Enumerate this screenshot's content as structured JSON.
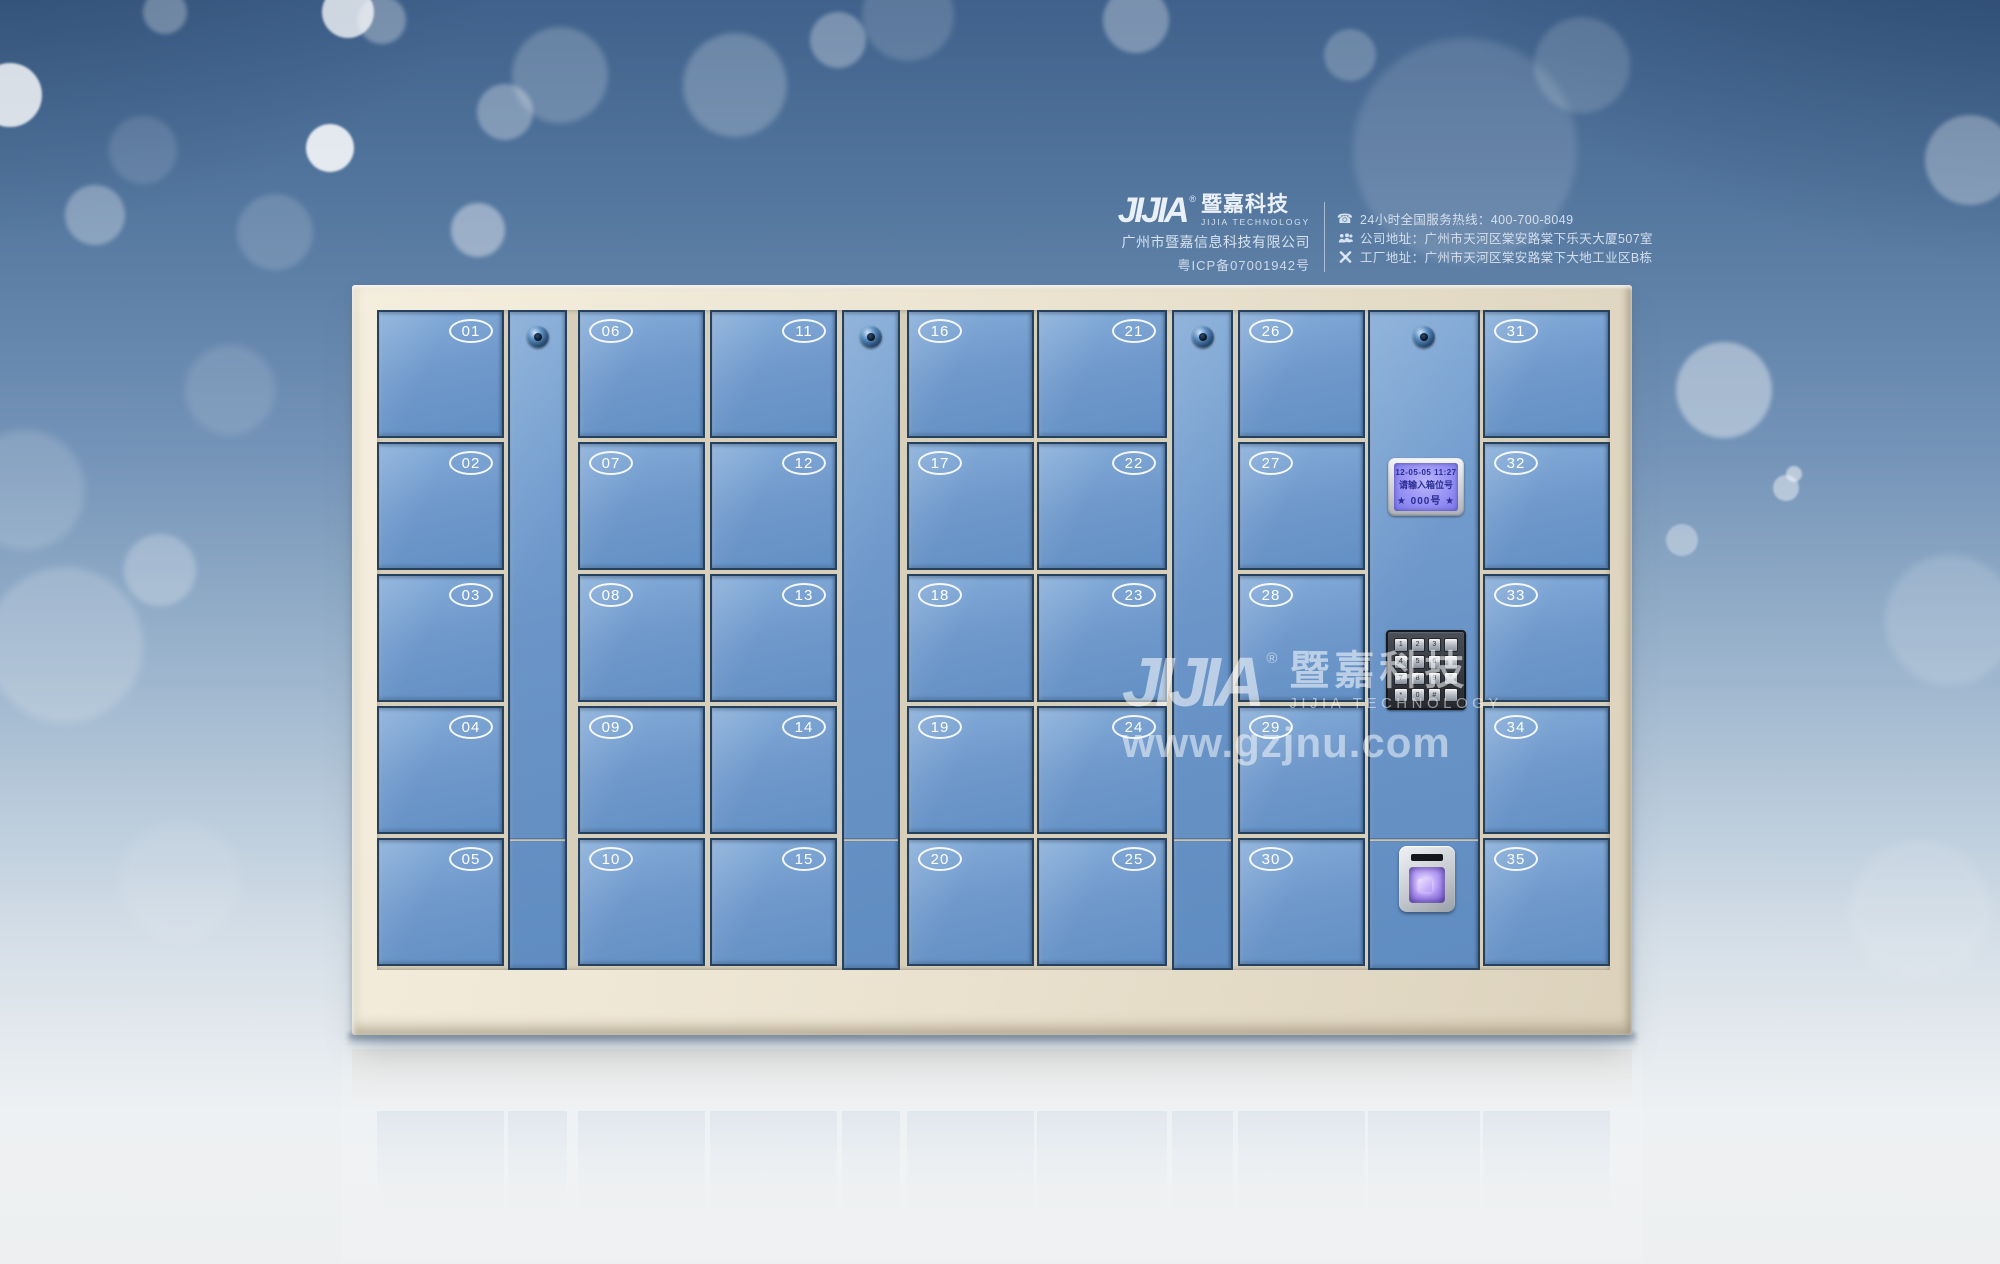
{
  "header": {
    "logo_text": "JIJIA",
    "logo_reg": "®",
    "brand_cn": "暨嘉科技",
    "brand_en": "JIJIA TECHNOLOGY",
    "company": "广州市暨嘉信息科技有限公司",
    "icp": "粤ICP备07001942号",
    "contacts": [
      {
        "icon": "phone-icon",
        "text": "24小时全国服务热线：400-700-8049"
      },
      {
        "icon": "people-icon",
        "text": "公司地址：广州市天河区棠安路棠下乐天大厦507室"
      },
      {
        "icon": "tools-icon",
        "text": "工厂地址：广州市天河区棠安路棠下大地工业区B栋"
      }
    ]
  },
  "watermark": {
    "logo_text": "JIJIA",
    "reg": "®",
    "brand_cn": "暨嘉科技",
    "brand_en": "JIJIA TECHNOLOGY",
    "website": "www.gzjnu.com"
  },
  "locker": {
    "columns": [
      {
        "type": "doors",
        "badge_side": "right",
        "numbers": [
          "01",
          "02",
          "03",
          "04",
          "05"
        ]
      },
      {
        "type": "lock_column"
      },
      {
        "type": "doors",
        "badge_side": "left",
        "numbers": [
          "06",
          "07",
          "08",
          "09",
          "10"
        ]
      },
      {
        "type": "doors",
        "badge_side": "right",
        "numbers": [
          "11",
          "12",
          "13",
          "14",
          "15"
        ]
      },
      {
        "type": "lock_column"
      },
      {
        "type": "doors",
        "badge_side": "left",
        "numbers": [
          "16",
          "17",
          "18",
          "19",
          "20"
        ]
      },
      {
        "type": "doors",
        "badge_side": "right",
        "numbers": [
          "21",
          "22",
          "23",
          "24",
          "25"
        ]
      },
      {
        "type": "lock_column"
      },
      {
        "type": "doors",
        "badge_side": "left",
        "numbers": [
          "26",
          "27",
          "28",
          "29",
          "30"
        ]
      },
      {
        "type": "control_column"
      },
      {
        "type": "doors",
        "badge_side": "left",
        "numbers": [
          "31",
          "32",
          "33",
          "34",
          "35"
        ]
      }
    ],
    "control": {
      "lcd": {
        "line1": "12-05-05 11:27",
        "line2": "请输入箱位号",
        "line3": "★ 000号 ★"
      },
      "keypad_keys": [
        "1",
        "2",
        "3",
        "",
        "4",
        "5",
        "6",
        "",
        "7",
        "8",
        "9",
        "",
        "*",
        "0",
        "#",
        ""
      ]
    }
  },
  "colors": {
    "door_blue": "#7099cb",
    "door_edge_navy": "#24415f",
    "frame_cream": "#ece4d1",
    "background_top_blue": "#3f618b",
    "lcd_screen_purple": "#938ef3",
    "fingerprint_glow_purple": "#b49bf5",
    "badge_white": "#ffffff"
  }
}
